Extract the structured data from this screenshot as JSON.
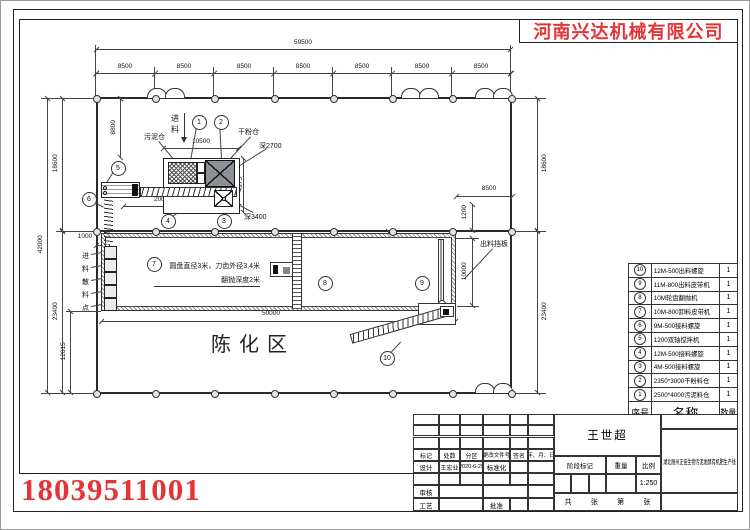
{
  "company": {
    "name": "河南兴达机械有限公司",
    "phone": "18039511001",
    "accent_color": "#e43435"
  },
  "drawing": {
    "area_label": "陈化区",
    "labels": {
      "feed_in": "进料",
      "sludge_silo": "污泥仓",
      "powder_silo": "干粉仓",
      "depth_2700": "深2700",
      "depth_3400": "深3400",
      "discharge_baffle": "出料挡板",
      "scatter_points": "进料散料点",
      "turner_note_1": "圆盘直径3米，刀齿外径3.4米",
      "turner_note_2": "翻抛深度2米"
    },
    "dim_labels": [
      "59500",
      "8500",
      "8500",
      "8500",
      "8500",
      "8500",
      "8500",
      "8500",
      "18600",
      "23400",
      "42000",
      "12015",
      "1000",
      "8800",
      "10500",
      "4975",
      "20000",
      "8500",
      "1200",
      "370",
      "10000",
      "50000",
      "18600",
      "23400"
    ],
    "balloons": [
      "1",
      "2",
      "3",
      "4",
      "5",
      "6",
      "7",
      "8",
      "9",
      "10"
    ]
  },
  "bom": {
    "headers": {
      "no": "序号",
      "name": "名称",
      "qty": "数量"
    },
    "rows": [
      {
        "no": "10",
        "name": "12M-500出料螺旋",
        "qty": "1"
      },
      {
        "no": "9",
        "name": "11M-800出料皮带机",
        "qty": "1"
      },
      {
        "no": "8",
        "name": "10M轮盘翻抛机",
        "qty": "1"
      },
      {
        "no": "7",
        "name": "10M-800卸料皮带机",
        "qty": "1"
      },
      {
        "no": "6",
        "name": "9M-500接料螺旋",
        "qty": "1"
      },
      {
        "no": "5",
        "name": "1200双轴搅拌机",
        "qty": "1"
      },
      {
        "no": "4",
        "name": "12M-500接料螺旋",
        "qty": "1"
      },
      {
        "no": "3",
        "name": "4M-500接料螺旋",
        "qty": "1"
      },
      {
        "no": "2",
        "name": "2350*3000干粉料仓",
        "qty": "1"
      },
      {
        "no": "1",
        "name": "2500*4000污泥料仓",
        "qty": "1"
      }
    ]
  },
  "title_block": {
    "drafter_name": "王世超",
    "project_name": "湖北随州正佳生物污泥发酵有机肥生产线",
    "mark_label": "标记",
    "count_label": "处数",
    "zone_label": "分区",
    "change_doc_label": "更改文件号",
    "sign_label": "签名",
    "date_label": "年、月、日",
    "design_label": "设计",
    "designer": "王宏业",
    "design_date": "2020-6-29",
    "standard_label": "标准化",
    "check_label": "审核",
    "process_label": "工艺",
    "approve_label": "批准",
    "stage_label": "阶段标记",
    "weight_label": "重量",
    "scale_label": "比例",
    "scale_value": "1:250",
    "total_label": "共",
    "sheet_label_1": "张",
    "ordinal_label": "第",
    "sheet_label_2": "张"
  }
}
